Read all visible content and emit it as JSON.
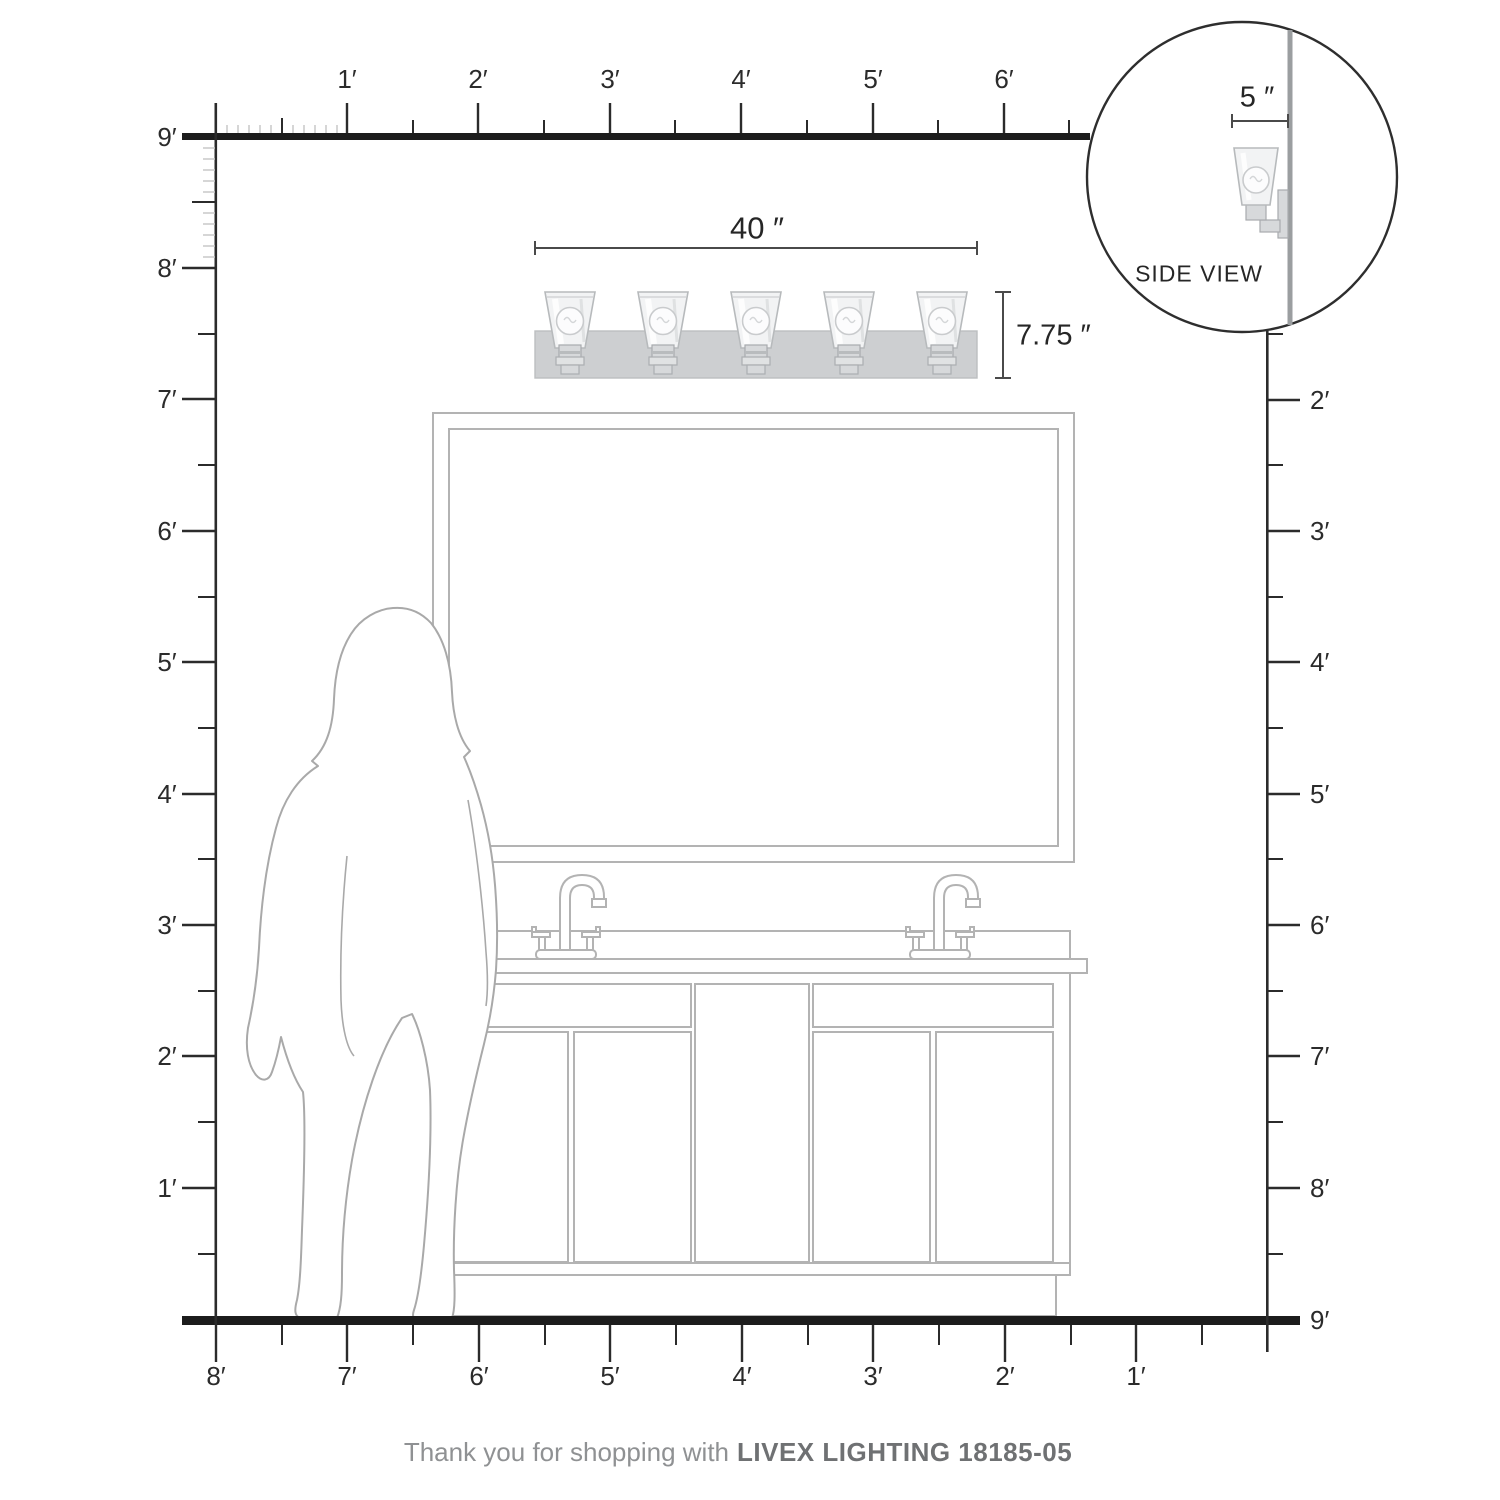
{
  "rulers": {
    "top_labels": [
      "1′",
      "2′",
      "3′",
      "4′",
      "5′",
      "6′"
    ],
    "left_labels": [
      "9′",
      "8′",
      "7′",
      "6′",
      "5′",
      "4′",
      "3′",
      "2′",
      "1′"
    ],
    "right_labels": [
      "2′",
      "3′",
      "4′",
      "5′",
      "6′",
      "7′",
      "8′",
      "9′"
    ],
    "bottom_labels": [
      "8′",
      "7′",
      "6′",
      "5′",
      "4′",
      "3′",
      "2′",
      "1′"
    ]
  },
  "fixture": {
    "lights_count": 5,
    "width_label": "40 ″",
    "height_label": "7.75 ″"
  },
  "side_view": {
    "label": "SIDE VIEW",
    "depth_label": "5 ″"
  },
  "footer": {
    "message": "Thank you for shopping with",
    "product": "LIVEX LIGHTING 18185-05"
  },
  "colors": {
    "ruler_line": "#1c1c1c",
    "tick": "#2b2b2b",
    "inch_tick": "#c8c8c8",
    "drawing_gray": "#b3b3b3",
    "silhouette_gray": "#a9a9a9",
    "dimension_line": "#4a4a4a",
    "fixture_plate": "#cdcfd1",
    "label_text": "#2b2b2b",
    "footer_text": "#8f9193",
    "footer_brand": "#6f7173"
  }
}
